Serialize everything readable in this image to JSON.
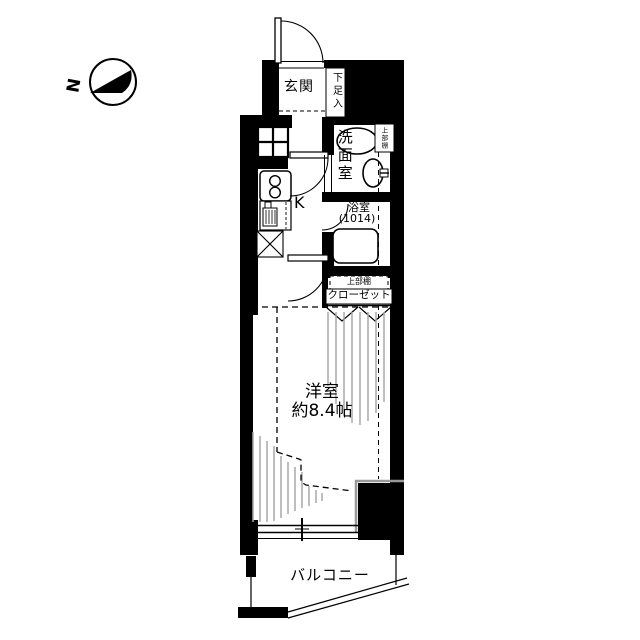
{
  "compass": {
    "north": "N"
  },
  "labels": {
    "entrance": "玄関",
    "shoe_cabinet": "下足入",
    "washroom": "洗面室",
    "washroom_upper_shelf": "上部棚",
    "bathroom": "浴室",
    "bathroom_size": "(1014)",
    "kitchen": "K",
    "closet_upper_shelf": "上部棚",
    "closet": "クローゼット",
    "main_room": "洋室",
    "main_room_size": "約8.4帖",
    "balcony": "バルコニー"
  },
  "icons": {
    "compass": "north-arrow-icon",
    "entrance_door": "swing-door-icon",
    "kitchen_door": "swing-door-icon",
    "room_door": "swing-door-icon",
    "bath_door": "swing-door-icon",
    "toilet": "toilet-icon",
    "basin": "washbasin-icon",
    "bathtub": "bathtub-icon",
    "stove": "two-burner-stove-icon",
    "sink": "kitchen-sink-icon",
    "appliance_space": "x-box-appliance-space-icon",
    "grid_panel": "four-pane-grid-icon",
    "closet_doors": "bifold-door-icon",
    "window": "sliding-window-icon",
    "sloped_ceiling": "hatch-lines-icon"
  },
  "colors": {
    "wall": "#000000",
    "background": "#ffffff",
    "hatch": "#a8a8a8",
    "pillar_trim": "#999999"
  }
}
